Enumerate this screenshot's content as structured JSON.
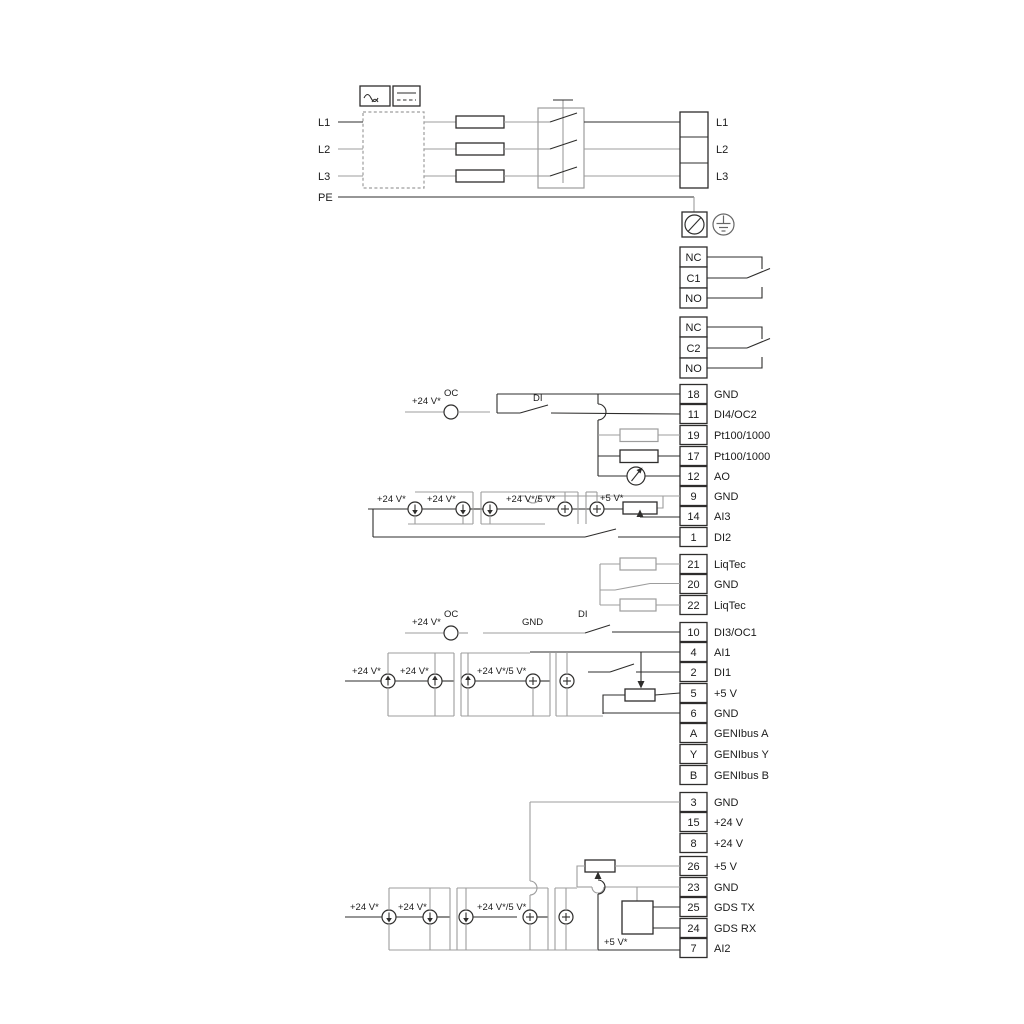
{
  "diagram": {
    "type": "electrical-wiring-diagram",
    "colors": {
      "background": "#ffffff",
      "wire_gray": "#9d9d9d",
      "wire_black": "#2e2d2c",
      "text": "#1b1b1b"
    },
    "mains": {
      "inputs": [
        "L1",
        "L2",
        "L3",
        "PE"
      ],
      "outputs": [
        "L1",
        "L2",
        "L3"
      ]
    },
    "relays": {
      "relay1": [
        "NC",
        "C1",
        "NO"
      ],
      "relay2": [
        "NC",
        "C2",
        "NO"
      ]
    },
    "labels": {
      "v24": "+24 V*",
      "v24_5": "+24 V*/5 V*",
      "v5": "+5 V*",
      "oc": "OC",
      "di": "DI",
      "gnd": "GND"
    },
    "terminal_groups": {
      "group1": [
        {
          "num": "18",
          "label": "GND"
        },
        {
          "num": "11",
          "label": "DI4/OC2"
        },
        {
          "num": "19",
          "label": "Pt100/1000"
        },
        {
          "num": "17",
          "label": "Pt100/1000"
        },
        {
          "num": "12",
          "label": "AO"
        },
        {
          "num": "9",
          "label": "GND"
        },
        {
          "num": "14",
          "label": "AI3"
        },
        {
          "num": "1",
          "label": "DI2"
        }
      ],
      "liqtec": [
        {
          "num": "21",
          "label": "LiqTec"
        },
        {
          "num": "20",
          "label": "GND"
        },
        {
          "num": "22",
          "label": "LiqTec"
        }
      ],
      "group2": [
        {
          "num": "10",
          "label": "DI3/OC1"
        },
        {
          "num": "4",
          "label": "AI1"
        },
        {
          "num": "2",
          "label": "DI1"
        },
        {
          "num": "5",
          "label": "+5 V"
        },
        {
          "num": "6",
          "label": "GND"
        },
        {
          "num": "A",
          "label": "GENIbus A"
        },
        {
          "num": "Y",
          "label": "GENIbus Y"
        },
        {
          "num": "B",
          "label": "GENIbus B"
        }
      ],
      "group3": [
        {
          "num": "3",
          "label": "GND"
        },
        {
          "num": "15",
          "label": "+24 V"
        },
        {
          "num": "8",
          "label": "+24 V"
        },
        {
          "num": "26",
          "label": "+5 V"
        },
        {
          "num": "23",
          "label": "GND"
        },
        {
          "num": "25",
          "label": "GDS TX"
        },
        {
          "num": "24",
          "label": "GDS RX"
        },
        {
          "num": "7",
          "label": "AI2"
        }
      ]
    }
  }
}
